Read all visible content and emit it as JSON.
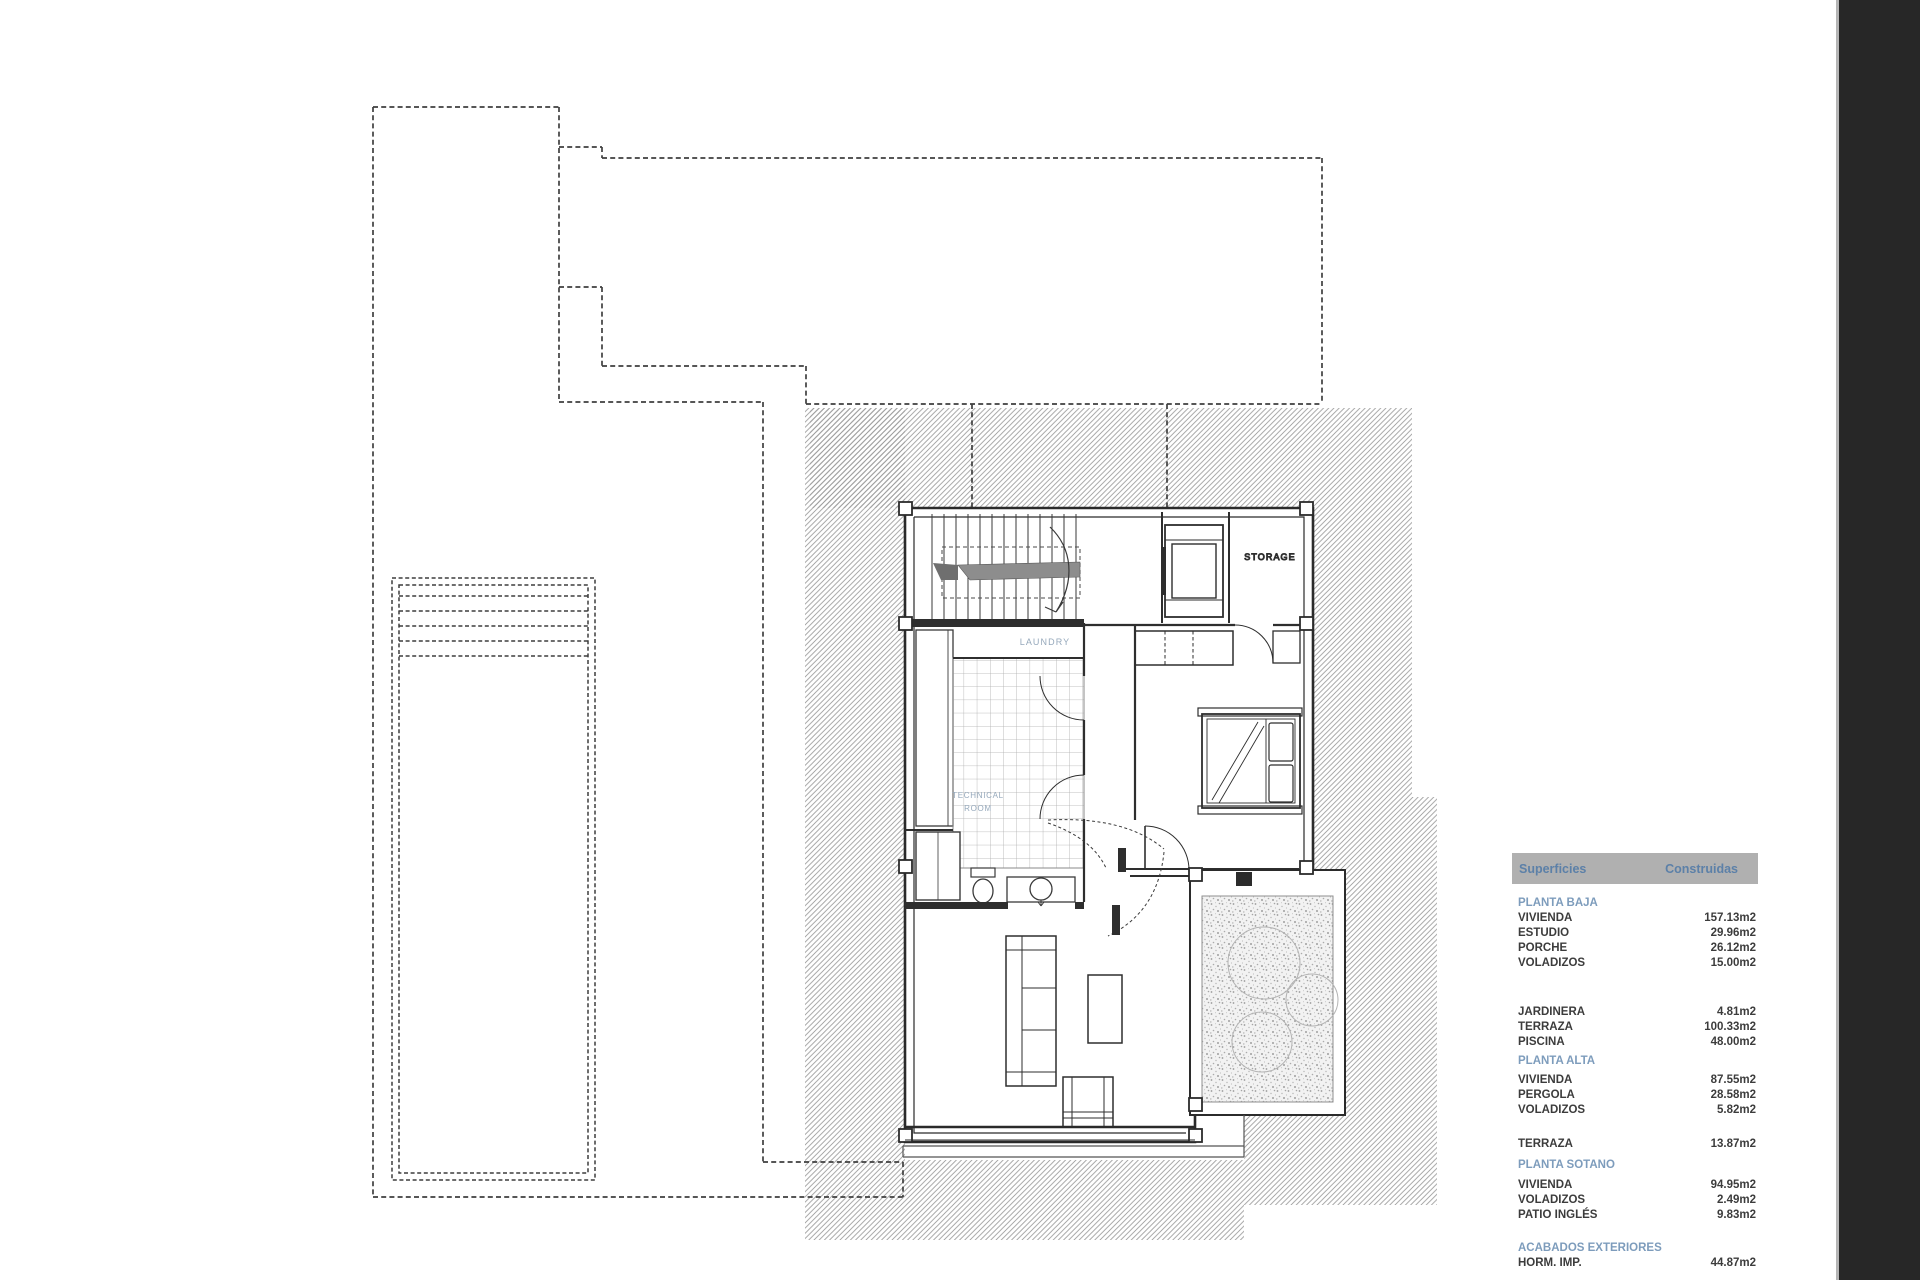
{
  "plan": {
    "labels": {
      "storage": "STORAGE",
      "laundry": "LAUNDRY",
      "technical_room_line1": "TECHNICAL",
      "technical_room_line2": "ROOM"
    },
    "label_color": "#95a8bb",
    "line_color": "#2e2e2e",
    "hatch_color": "#9c9c9c"
  },
  "table": {
    "header": {
      "col1": "Superficies",
      "col2": "Construidas",
      "bg": "#b0b0b0",
      "text_color": "#5c80a8"
    },
    "section_color": "#7d9cbc",
    "row_color": "#3c3c3c",
    "rows": [
      {
        "type": "section",
        "label": "PLANTA BAJA",
        "value": ""
      },
      {
        "type": "data",
        "label": "VIVIENDA",
        "value": "157.13m2"
      },
      {
        "type": "data",
        "label": "ESTUDIO",
        "value": "29.96m2"
      },
      {
        "type": "data",
        "label": "PORCHE",
        "value": "26.12m2"
      },
      {
        "type": "data",
        "label": "VOLADIZOS",
        "value": "15.00m2"
      },
      {
        "type": "data",
        "label": "JARDINERA",
        "value": "4.81m2"
      },
      {
        "type": "data",
        "label": "TERRAZA",
        "value": "100.33m2"
      },
      {
        "type": "data",
        "label": "PISCINA",
        "value": "48.00m2"
      },
      {
        "type": "section",
        "label": "PLANTA ALTA",
        "value": ""
      },
      {
        "type": "data",
        "label": "VIVIENDA",
        "value": "87.55m2"
      },
      {
        "type": "data",
        "label": "PERGOLA",
        "value": "28.58m2"
      },
      {
        "type": "data",
        "label": "VOLADIZOS",
        "value": "5.82m2"
      },
      {
        "type": "data",
        "label": "TERRAZA",
        "value": "13.87m2"
      },
      {
        "type": "section",
        "label": "PLANTA SOTANO",
        "value": ""
      },
      {
        "type": "data",
        "label": "VIVIENDA",
        "value": "94.95m2"
      },
      {
        "type": "data",
        "label": "VOLADIZOS",
        "value": "2.49m2"
      },
      {
        "type": "data",
        "label": "PATIO INGLÉS",
        "value": "9.83m2"
      },
      {
        "type": "section",
        "label": "ACABADOS EXTERIORES",
        "value": ""
      },
      {
        "type": "data",
        "label": "HORM. IMP.",
        "value": "44.87m2"
      }
    ]
  },
  "side_strip_color": "#272727"
}
